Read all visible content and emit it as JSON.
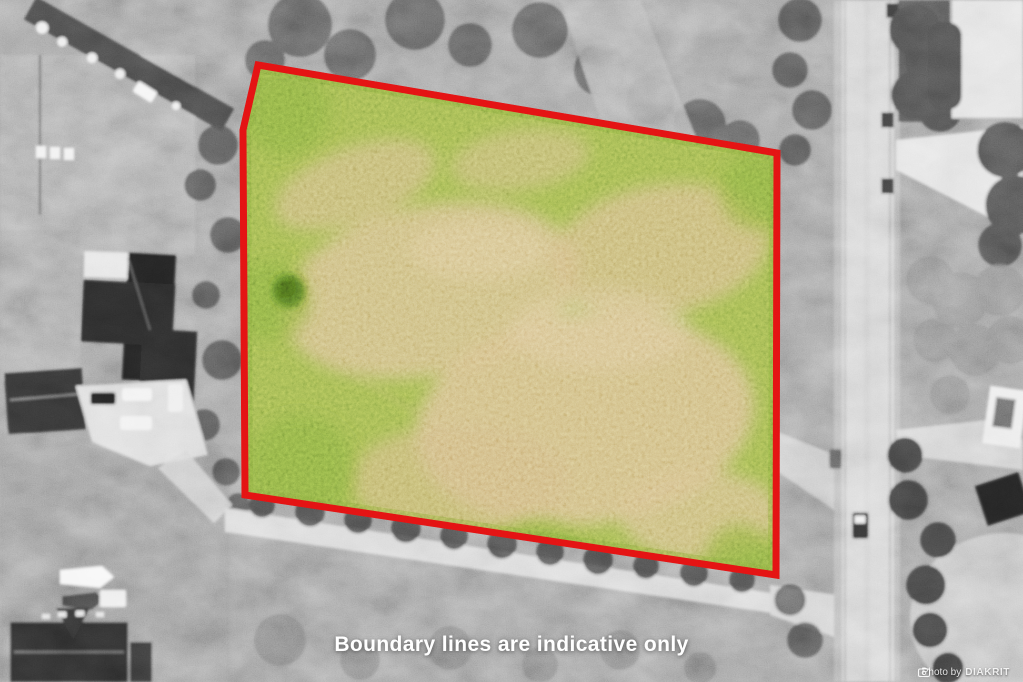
{
  "scene": {
    "description": "Grayscale aerial drone photograph of rural properties; the land parcel for sale is shown in colour (green/tan grass) and outlined in red, everything else desaturated",
    "disclaimer": "Boundary lines are indicative only",
    "watermark": {
      "icon": "camera-icon",
      "prefix": "Photo by",
      "brand": "DIAKRIT"
    },
    "parcel": {
      "boundary_points": "258,65 777,153 776,575 245,495 243,130",
      "boundary_color": "#e01111",
      "field_green": "#7f9e3f",
      "field_tan": "#c6a76b"
    },
    "colors": {
      "background_gray": "#858585",
      "road_gray": "#c8c8c8",
      "tree_dark_gray": "#3f3f3f",
      "text_white": "#ffffff"
    }
  }
}
